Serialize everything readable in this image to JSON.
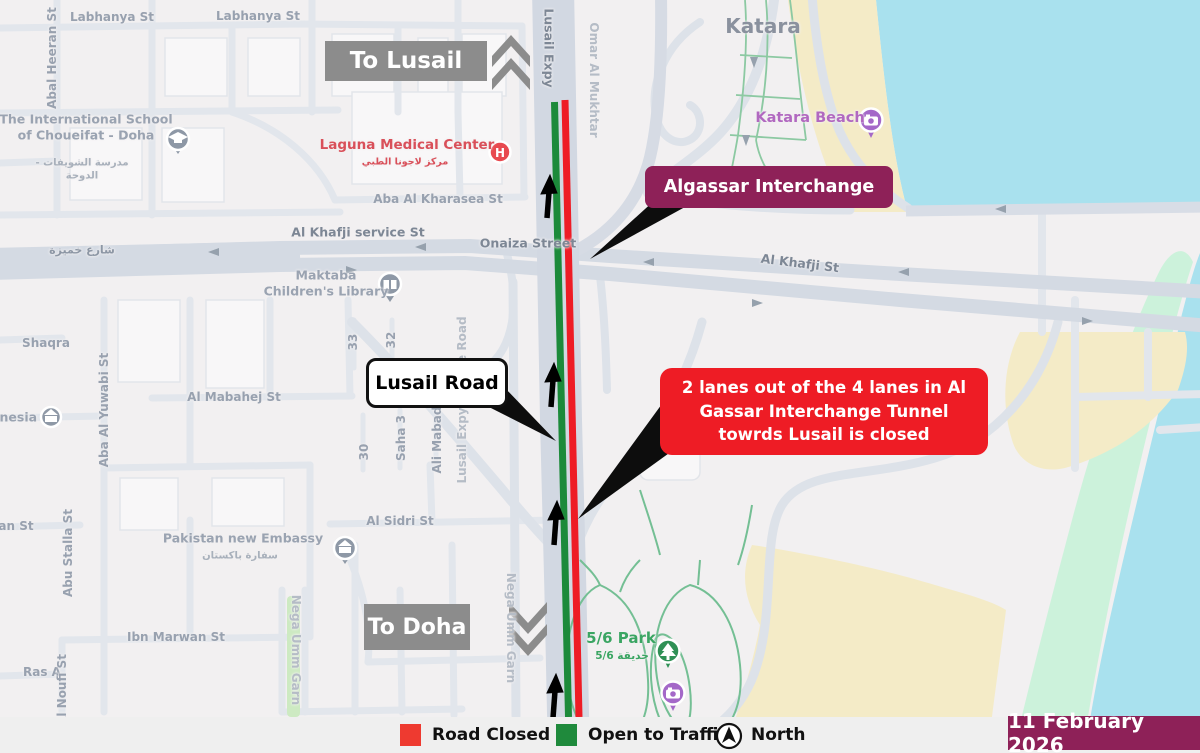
{
  "signs": {
    "to_lusail": "To Lusail",
    "to_doha": "To Doha"
  },
  "callouts": {
    "algassar": {
      "label": "Algassar Interchange"
    },
    "lusail_road": {
      "label": "Lusail Road"
    },
    "closure": {
      "label": "2 lanes out of the 4 lanes in Al Gassar Interchange Tunnel towrds Lusail is closed"
    }
  },
  "legend": {
    "items": [
      {
        "id": "road-closed",
        "label": "Road Closed",
        "color": "#ee3a30"
      },
      {
        "id": "open-to-traffic",
        "label": "Open to Traffic",
        "color": "#1f8a3c"
      }
    ],
    "north_label": "North"
  },
  "date_badge": {
    "label": "11 February 2026"
  },
  "colors": {
    "closed_line": "#ee1c25",
    "open_line": "#1c8a3a",
    "accent_maroon": "#8e2158",
    "sign_gray": "#8c8c8c",
    "water": "#a9e1ee",
    "beach": "#f4ebc7",
    "callout_red": "#ee1c25"
  },
  "map": {
    "labels": [
      {
        "id": "labhanya-1",
        "text": "Labhanya St",
        "x": 112,
        "y": 17,
        "cls": "road"
      },
      {
        "id": "labhanya-2",
        "text": "Labhanya St",
        "x": 258,
        "y": 16,
        "cls": "road"
      },
      {
        "id": "abal-heeran",
        "text": "Abal Heeran St",
        "x": 52,
        "y": 58,
        "cls": "road vert"
      },
      {
        "id": "school",
        "text": "The International School of Choueifat - Doha",
        "x": 86,
        "y": 127,
        "w": 175,
        "cls": "area wrap"
      },
      {
        "id": "school-ar",
        "text": "مدرسة الشويفات - الدوحة",
        "x": 82,
        "y": 170,
        "w": 110,
        "cls": "ar wrap"
      },
      {
        "id": "laguna",
        "text": "Laguna Medical Center",
        "x": 407,
        "y": 145,
        "cls": "red"
      },
      {
        "id": "laguna-ar",
        "text": "مركز لاجونا الطبي",
        "x": 405,
        "y": 162,
        "cls": "red-ar"
      },
      {
        "id": "aba-kharasea",
        "text": "Aba Al Kharasea St",
        "x": 438,
        "y": 199,
        "cls": "road"
      },
      {
        "id": "khafji-service",
        "text": "Al Khafji service St",
        "x": 358,
        "y": 232,
        "cls": "road-dark"
      },
      {
        "id": "sharia-khamiza-ar",
        "text": "شارع خميزة",
        "x": 82,
        "y": 250,
        "cls": "road-ar"
      },
      {
        "id": "onaiza",
        "text": "Onaiza Street",
        "x": 528,
        "y": 243,
        "cls": "road-dark"
      },
      {
        "id": "khafji",
        "text": "Al Khafji St",
        "x": 800,
        "y": 263,
        "rot": 7,
        "cls": "road-dark"
      },
      {
        "id": "maktaba",
        "text": "Maktaba Children's Library",
        "x": 326,
        "y": 283,
        "w": 130,
        "cls": "area wrap"
      },
      {
        "id": "katara",
        "text": "Katara",
        "x": 763,
        "y": 26,
        "cls": "big"
      },
      {
        "id": "katara-beach",
        "text": "Katara Beach",
        "x": 810,
        "y": 118,
        "cls": "purple"
      },
      {
        "id": "shaqra",
        "text": "Shaqra",
        "x": 46,
        "y": 343,
        "cls": "road"
      },
      {
        "id": "onesia",
        "text": "onesia",
        "x": 14,
        "y": 417,
        "cls": "area"
      },
      {
        "id": "aba-yuwabi",
        "text": "Aba Al Yuwabi St",
        "x": 104,
        "y": 410,
        "cls": "road vert"
      },
      {
        "id": "mabahej",
        "text": "Al Mabahej St",
        "x": 234,
        "y": 397,
        "cls": "road"
      },
      {
        "id": "abu-stalla",
        "text": "Abu Stalla St",
        "x": 68,
        "y": 553,
        "cls": "road vert"
      },
      {
        "id": "an-st",
        "text": "an St",
        "x": 16,
        "y": 526,
        "cls": "road"
      },
      {
        "id": "sidri",
        "text": "Al Sidri St",
        "x": 400,
        "y": 521,
        "cls": "road"
      },
      {
        "id": "pakistan",
        "text": "Pakistan new Embassy",
        "x": 243,
        "y": 538,
        "cls": "area"
      },
      {
        "id": "pakistan-ar",
        "text": "سفارة باكستان",
        "x": 240,
        "y": 556,
        "cls": "ar"
      },
      {
        "id": "ibn-marwan",
        "text": "Ibn Marwan St",
        "x": 176,
        "y": 637,
        "cls": "road"
      },
      {
        "id": "ras",
        "text": "Ras A",
        "x": 42,
        "y": 672,
        "cls": "road"
      },
      {
        "id": "noufi",
        "text": "Al Noufi St",
        "x": 62,
        "y": 690,
        "cls": "road vert"
      },
      {
        "id": "nega-1",
        "text": "Nega Umm Garn",
        "x": 296,
        "y": 650,
        "rot": 90,
        "cls": "road-light"
      },
      {
        "id": "nega-2",
        "text": "Nega Umm Garn",
        "x": 511,
        "y": 628,
        "rot": 90,
        "cls": "road-light"
      },
      {
        "id": "park",
        "text": "5/6 Park",
        "x": 621,
        "y": 638,
        "cls": "green-big"
      },
      {
        "id": "park-ar",
        "text": "حديقة 5/6",
        "x": 622,
        "y": 656,
        "cls": "green-ar"
      },
      {
        "id": "service-road",
        "text": "Lusail Expy service Road",
        "x": 462,
        "y": 400,
        "cls": "road-light vert"
      },
      {
        "id": "ali-mabad",
        "text": "Ali Mabad",
        "x": 437,
        "y": 440,
        "cls": "road vert"
      },
      {
        "id": "saha",
        "text": "Saha 3",
        "x": 401,
        "y": 438,
        "cls": "road vert"
      },
      {
        "id": "n30",
        "text": "30",
        "x": 364,
        "y": 452,
        "cls": "road vert"
      },
      {
        "id": "n32",
        "text": "32",
        "x": 391,
        "y": 340,
        "cls": "road vert"
      },
      {
        "id": "n33",
        "text": "33",
        "x": 353,
        "y": 342,
        "cls": "road vert"
      },
      {
        "id": "omar-al-mukhtar",
        "text": "Omar Al Mukhtar",
        "x": 594,
        "y": 80,
        "rot": 90,
        "cls": "road-light"
      },
      {
        "id": "lusail-expy",
        "text": "Lusail Expy",
        "x": 549,
        "y": 48,
        "rot": 90,
        "cls": "road-dark"
      }
    ]
  }
}
